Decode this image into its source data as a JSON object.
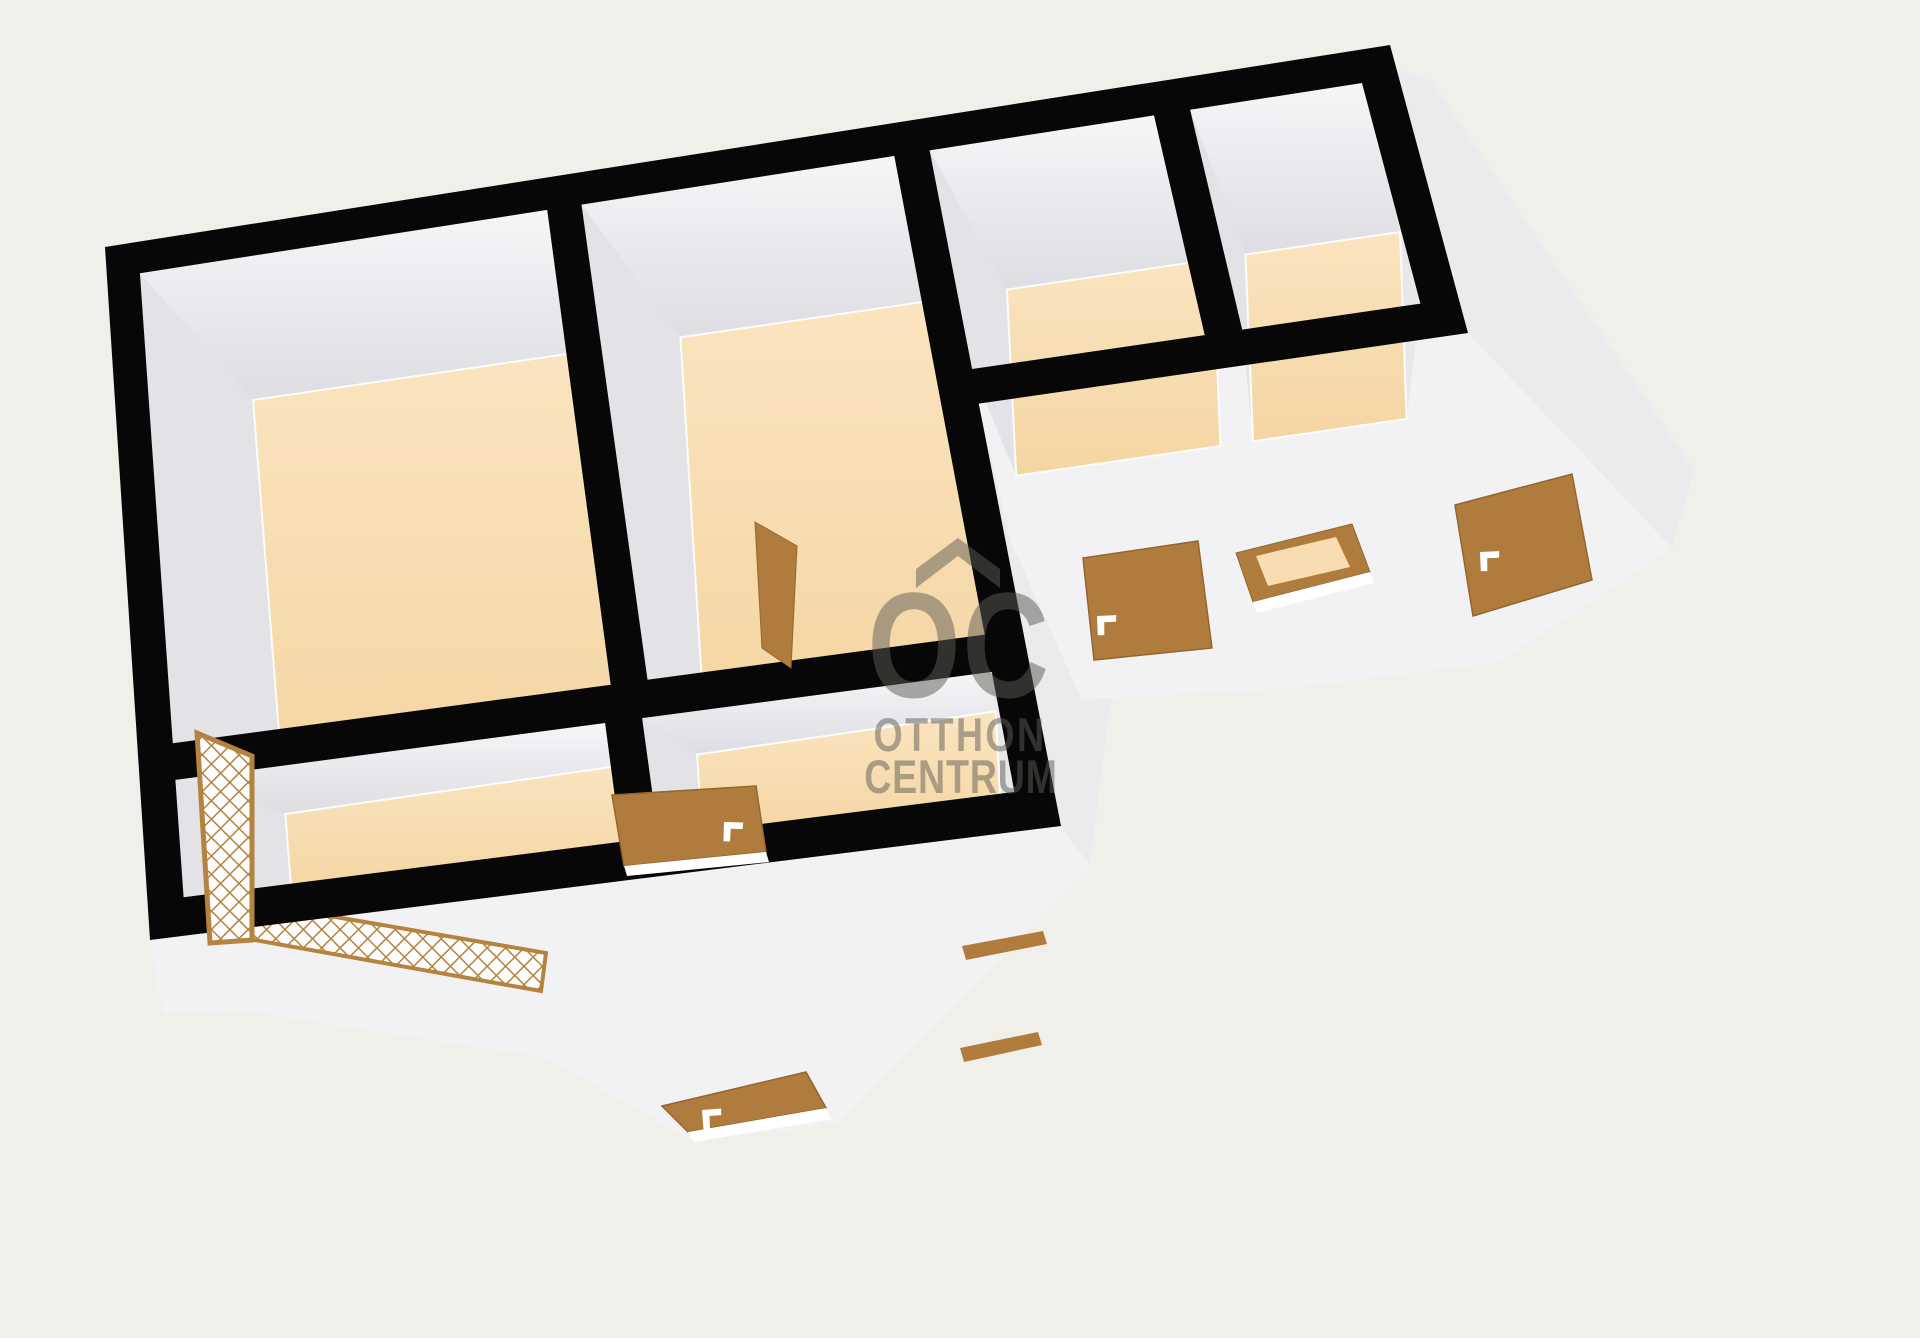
{
  "page": {
    "background": "#f1efe9",
    "type_label": "3D floor plan render"
  },
  "watermark": {
    "initials": "OC",
    "line1": "OTTHON",
    "line2": "CENTRUM",
    "color": "#5f5c55",
    "opacity": 0.5,
    "roof_icon": "roof-chevron-icon"
  },
  "palette": {
    "wall_outline": "#070707",
    "floor_light": "#fae4c0",
    "floor_dark": "#f5d5a2",
    "floor_mid": "#f8dcb0",
    "wall_face_north_top": "#f6f6f8",
    "wall_face_north_bottom": "#dddde3",
    "wall_face_west": "#e2e2e7",
    "wall_face_east": "#e8e8eb",
    "exterior_face": "#f2f2f4",
    "exterior_face_shaded": "#ebebee",
    "door": "#b07c3e",
    "door_edge": "#92662f",
    "lattice": "#b5833f",
    "window_glass": "#f7ddb1",
    "sill_white": "#ffffff"
  },
  "inventory": {
    "rooms": [
      {
        "id": "room-1"
      },
      {
        "id": "room-2"
      },
      {
        "id": "room-3"
      },
      {
        "id": "room-4"
      },
      {
        "id": "room-5"
      },
      {
        "id": "room-6"
      }
    ],
    "doors": [
      {
        "id": "entry-door",
        "location": "front-exterior-wall"
      },
      {
        "id": "wing-door-1",
        "location": "right-wing-exterior-wall"
      },
      {
        "id": "wing-door-2",
        "location": "right-wing-exterior-wall"
      },
      {
        "id": "interior-door-open",
        "location": "middle-wall"
      },
      {
        "id": "interior-door-leaning",
        "location": "room-divider-wall"
      }
    ],
    "windows": [
      {
        "id": "lattice-window-side",
        "location": "left-wall"
      },
      {
        "id": "lattice-window-front",
        "location": "front-exterior-wall"
      },
      {
        "id": "small-window",
        "location": "right-wing-exterior-wall"
      },
      {
        "id": "slot-window-a",
        "location": "front-exterior-wall"
      },
      {
        "id": "slot-window-b",
        "location": "front-exterior-wall"
      }
    ]
  }
}
